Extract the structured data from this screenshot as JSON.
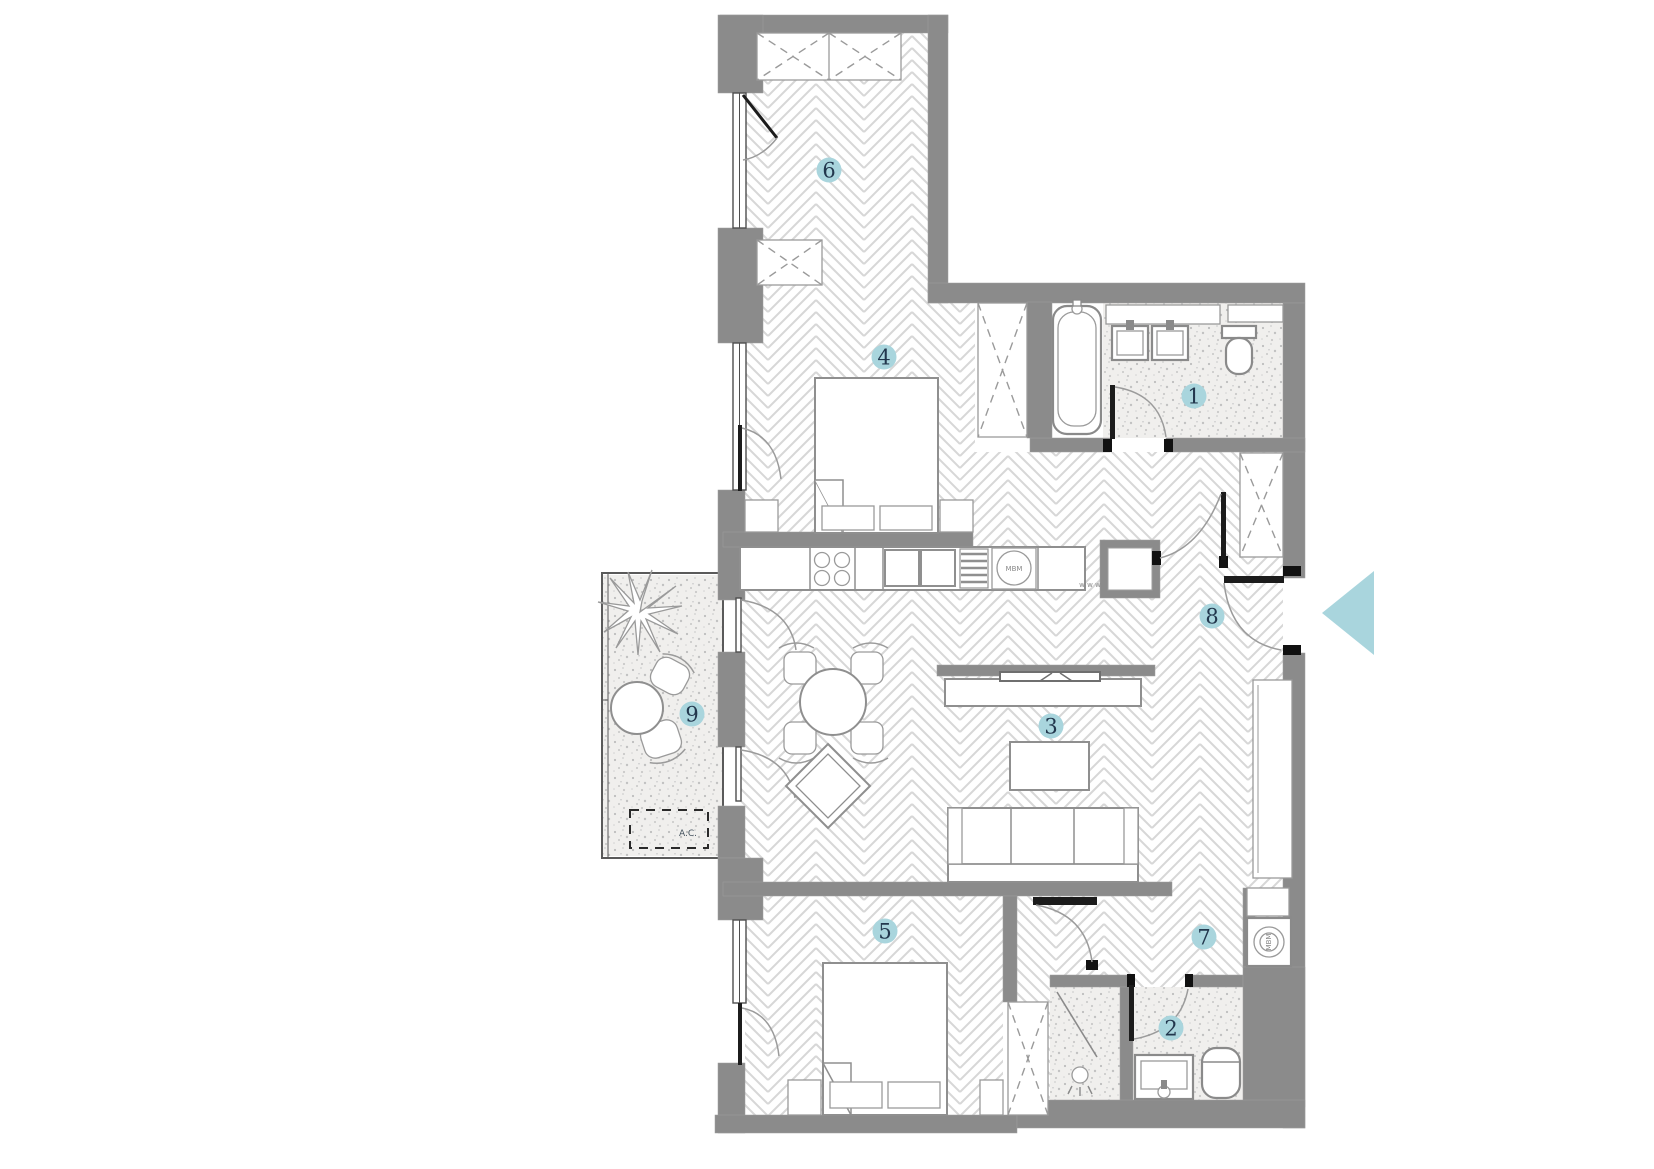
{
  "plan": {
    "colors": {
      "accent": "#a9d5dd",
      "wall": "#8b8b8b",
      "number": "#22374d",
      "floor_line": "#d7d7d7"
    },
    "room_markers": [
      {
        "id": "1",
        "x": 1194,
        "y": 396
      },
      {
        "id": "2",
        "x": 1171,
        "y": 1028
      },
      {
        "id": "3",
        "x": 1051,
        "y": 726
      },
      {
        "id": "4",
        "x": 884,
        "y": 357
      },
      {
        "id": "5",
        "x": 885,
        "y": 931
      },
      {
        "id": "6",
        "x": 829,
        "y": 170
      },
      {
        "id": "7",
        "x": 1204,
        "y": 937
      },
      {
        "id": "8",
        "x": 1212,
        "y": 616
      },
      {
        "id": "9",
        "x": 692,
        "y": 714
      }
    ],
    "texts": {
      "ac_unit": "A.C.",
      "washing_machine_label": "MBM",
      "kitchen_appliance_label": "MBM",
      "counter_marks": "w w w"
    },
    "entrance_arrow": {
      "direction": "left",
      "color": "#a9d5dd"
    }
  }
}
